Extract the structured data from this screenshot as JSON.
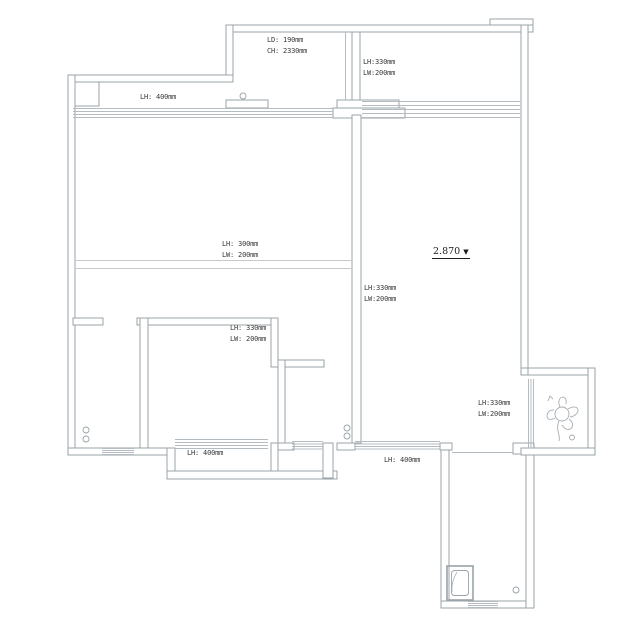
{
  "drawing": {
    "type": "apartment-floor-plan",
    "colors": {
      "wall": "#9aa3a8",
      "hatch": "#b4bcc2",
      "beam_line": "#c3c9cd",
      "text": "#3a3a3a",
      "bg": "#ffffff"
    }
  },
  "annotations": {
    "top_room": {
      "line1": "LD: 190mm",
      "line2": "CH: 2330mm"
    },
    "top_right": {
      "line1": "LH:330mm",
      "line2": "LW:200mm"
    },
    "top_left_win": {
      "line1": "LH: 400mm"
    },
    "living_beam": {
      "line1": "LH: 300mm",
      "line2": "LW: 200mm"
    },
    "divider_beam": {
      "line1": "LH:330mm",
      "line2": "LW:200mm"
    },
    "hall_beam": {
      "line1": "LH: 330mm",
      "line2": "LW: 200mm"
    },
    "bottom_bay": {
      "line1": "LH: 400mm"
    },
    "bottom_right": {
      "line1": "LH: 400mm"
    },
    "right_alcove": {
      "line1": "LH:330mm",
      "line2": "LW:200mm"
    },
    "elevation": {
      "value": "2.870",
      "symbol": "▼"
    }
  }
}
